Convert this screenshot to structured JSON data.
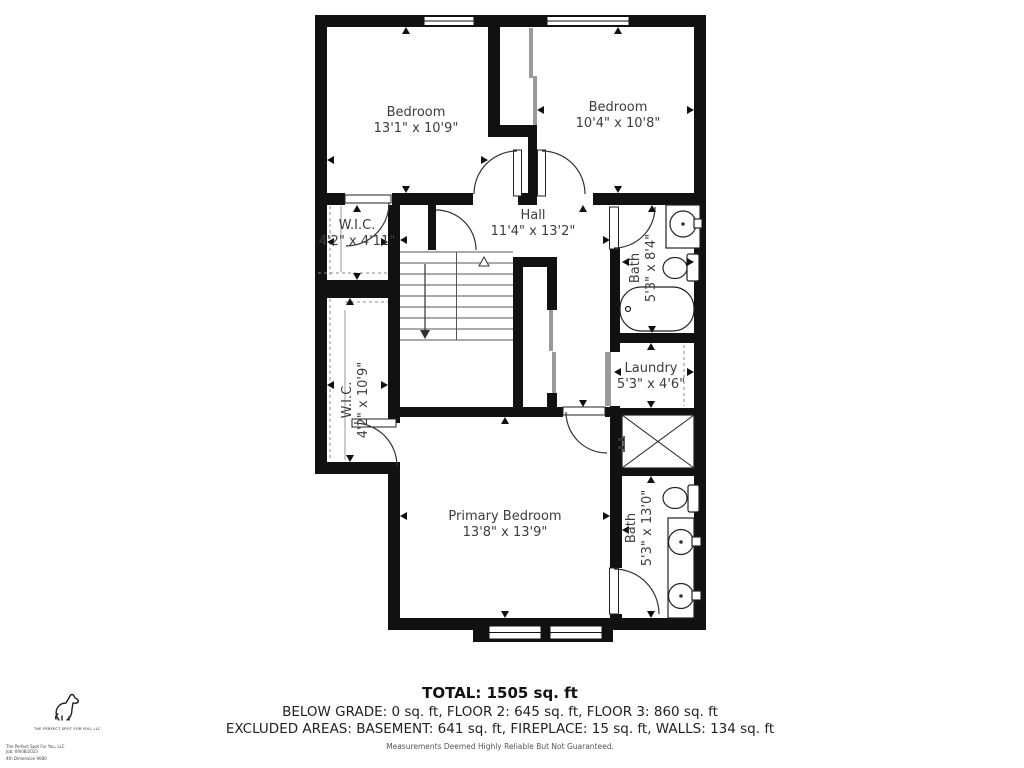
{
  "rooms": [
    {
      "name": "Bedroom",
      "dims": "13'1\" x 10'9\""
    },
    {
      "name": "Bedroom",
      "dims": "10'4\" x 10'8\""
    },
    {
      "name": "Hall",
      "dims": "11'4\" x 13'2\""
    },
    {
      "name": "W.I.C.",
      "dims": "4'2\" x 4'11\""
    },
    {
      "name": "W.I.C.",
      "dims": "4'2\" x 10'9\""
    },
    {
      "name": "Bath",
      "dims": "5'3\" x 8'4\""
    },
    {
      "name": "Laundry",
      "dims": "5'3\" x 4'6\""
    },
    {
      "name": "Primary Bedroom",
      "dims": "13'8\" x 13'9\""
    },
    {
      "name": "Bath",
      "dims": "5'3\" x 13'0\""
    }
  ],
  "summary": {
    "total": "TOTAL: 1505 sq. ft",
    "line2": "BELOW GRADE: 0 sq. ft, FLOOR 2: 645 sq. ft, FLOOR 3: 860 sq. ft",
    "line3": "EXCLUDED AREAS: BASEMENT: 641 sq. ft, FIREPLACE: 15 sq. ft, WALLS: 134 sq. ft",
    "disclaimer": "Measurements Deemed Highly Reliable But Not Guaranteed."
  },
  "branding": {
    "company": "THE PERFECT SPOT FOR YOU, LLC",
    "fine_print": [
      "The Perfect Spot For You, LLC",
      "Job: 09/08/2023",
      "4th Dimension 9080"
    ]
  }
}
